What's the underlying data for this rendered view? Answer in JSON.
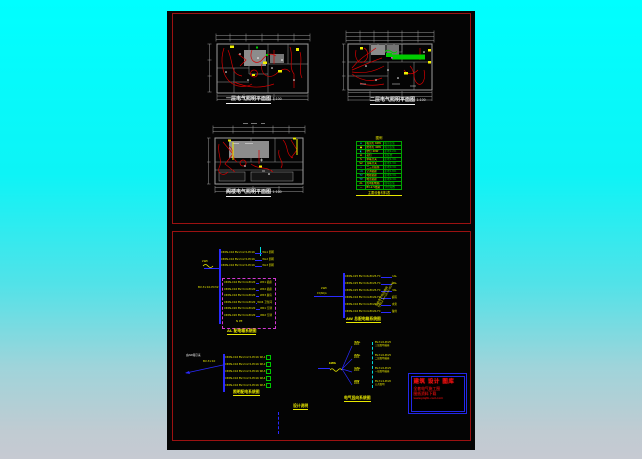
{
  "colors": {
    "background_top": "#00ffff",
    "background_bottom": "#c6cad2",
    "paper": "#040404",
    "sheet_border": "#9b1111",
    "wiring_red": "#d40000",
    "wall_gray": "#9c9c9c",
    "circuit_blue": "#2a2aff",
    "text_yellow": "#e8e800",
    "legend_green": "#00d400",
    "highlight_green": "#00cc00",
    "dashed_magenta": "#d438d4",
    "stamp_blue": "#2328e8",
    "stamp_red": "#e51212"
  },
  "plans": [
    {
      "caption": "一层电气照明平面图",
      "scale": "1:100"
    },
    {
      "caption": "二层电气照明平面图",
      "scale": "1:100"
    },
    {
      "caption": "阁楼电气照明平面图",
      "scale": "1:100"
    }
  ],
  "legend": {
    "title": "图例",
    "caption": "主要设备材料表",
    "rows": [
      {
        "sym": "⊕",
        "name": "吸顶灯 60W",
        "spec": "吸顶安装"
      },
      {
        "sym": "●",
        "name": "防水灯 40W",
        "spec": "吸顶安装"
      },
      {
        "sym": "◐",
        "name": "壁灯 40W",
        "spec": "距地2.2m"
      },
      {
        "sym": "⊗",
        "name": "花灯",
        "spec": "见装修"
      },
      {
        "sym": "S",
        "name": "单联开关",
        "spec": "距地1.3m"
      },
      {
        "sym": "S2",
        "name": "双联开关",
        "spec": "距地1.3m"
      },
      {
        "sym": "⊥",
        "name": "二三孔插座",
        "spec": "距地0.3m"
      },
      {
        "sym": "⊥K",
        "name": "空调插座",
        "spec": "距地1.8m"
      },
      {
        "sym": "TV",
        "name": "电视插座",
        "spec": "距地0.3m"
      },
      {
        "sym": "TP",
        "name": "电话插座",
        "spec": "距地0.3m"
      },
      {
        "sym": "AL",
        "name": "照明配电箱",
        "spec": "嵌墙安装"
      },
      {
        "sym": "—",
        "name": "BV-2.5线路",
        "spec": "穿管暗敷"
      }
    ]
  },
  "panel1": {
    "incoming_label": "kWh",
    "incoming_spec": "BV-3×10-PC32",
    "top_rows": [
      {
        "spec": "C65N-C16 BV-2×2.5-PC16",
        "tag": "WL1 照明"
      },
      {
        "spec": "C65N-C16 BV-2×2.5-PC16",
        "tag": "WL2 照明"
      },
      {
        "spec": "C65N-C16 BV-3×2.5-PC16",
        "tag": "WL3 照明"
      }
    ],
    "box_rows": [
      {
        "spec": "C65N-C16 BV-3×4-PC20",
        "tag": "WX1 插座"
      },
      {
        "spec": "C65N-C16 BV-3×4-PC20",
        "tag": "WX2 插座"
      },
      {
        "spec": "C65N-C16 BV-3×4-PC20",
        "tag": "WX3 厨房"
      },
      {
        "spec": "C65N-C16 BV-3×4-PC20",
        "tag": "WX4 卫生间"
      },
      {
        "spec": "C65N-C20 BV-3×4-PC20",
        "tag": "WK1 空调"
      },
      {
        "spec": "C65N-C20 BV-3×4-PC20",
        "tag": "WK2 空调"
      }
    ],
    "box_note": "N PE",
    "caption": "AL 配电箱系统图"
  },
  "panel2": {
    "incoming_label": "kWh",
    "incoming_sub": "15(60)A",
    "rows": [
      {
        "spec": "C65N-C25 BV-3×6-PC25-FC",
        "tag": "1AL"
      },
      {
        "spec": "C65N-C25 BV-3×6-PC25-FC",
        "tag": "2AL"
      },
      {
        "spec": "C65N-C25 BV-3×6-PC25-FC",
        "tag": "3AL"
      },
      {
        "spec": "C65N-C16 BV-3×4-PC20-FC",
        "tag": "庭院"
      },
      {
        "spec": "C65N-C16 BV-3×4-PC20-FC",
        "tag": "水泵"
      },
      {
        "spec": "C65N-C16 BV-3×4-PC20-FC",
        "tag": "备用"
      }
    ],
    "note_line1": "引自室外低压电网",
    "note_line2": "YJV22-4×16-SC40-FC",
    "caption": "AW 总配电箱系统图"
  },
  "panel3": {
    "note_white": "由AW箱引来",
    "note_yellow": "BV-3×10",
    "rows": [
      {
        "spec": "C65N-C16 BV-2×2.5-PC16",
        "tag": "WL1"
      },
      {
        "spec": "C65N-C16 BV-2×2.5-PC16",
        "tag": "WL2"
      },
      {
        "spec": "C65N-C16 BV-2×2.5-PC16",
        "tag": "WL3"
      },
      {
        "spec": "C65N-C16 BV-3×2.5-PC16",
        "tag": "WL4"
      },
      {
        "spec": "C65N-C16 BV-3×2.5-PC16",
        "tag": "WL5"
      }
    ],
    "caption": "照明配电系统图"
  },
  "panel4": {
    "meter_label": "kWh",
    "branches": [
      {
        "label": "3AL",
        "sub": "kWh",
        "desc1": "BV-3×6-PC25",
        "desc2": "三层照明插座"
      },
      {
        "label": "2AL",
        "sub": "kWh",
        "desc1": "BV-3×6-PC25",
        "desc2": "二层照明插座"
      },
      {
        "label": "1AL",
        "sub": "kWh",
        "desc1": "BV-3×6-PC25",
        "desc2": "一层照明插座"
      },
      {
        "label": "AW",
        "sub": "kWh",
        "desc1": "BV-3×4-PC20",
        "desc2": "公共照明"
      }
    ],
    "caption": "电气竖向系统图"
  },
  "small_caption": "设计说明",
  "stamp": {
    "line1": "建筑 设计 图库",
    "line2": "全套电气施工图",
    "line3": "图纸资料下载",
    "line4": "www.jzsjtk-cad.com"
  }
}
